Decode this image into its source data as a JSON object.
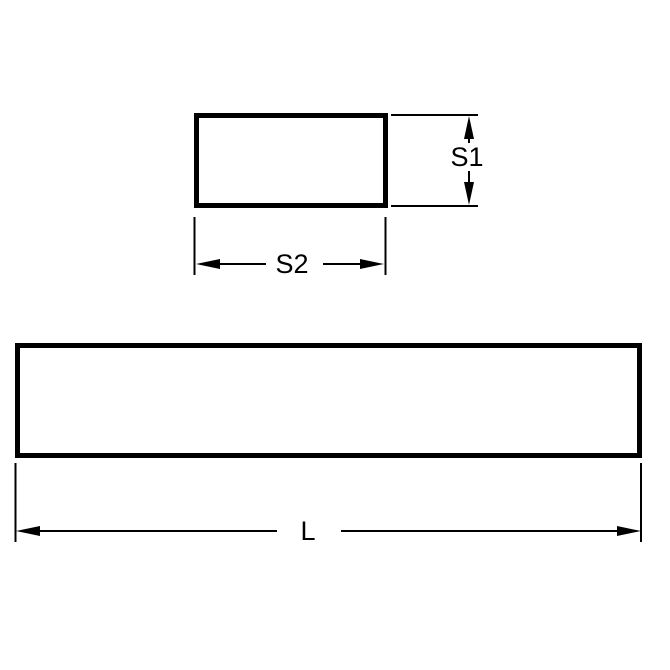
{
  "diagram": {
    "type": "engineering-dimension-drawing",
    "labels": {
      "section_height": "S1",
      "section_width": "S2",
      "length": "L"
    },
    "colors": {
      "line": "#000000",
      "background": "#ffffff"
    }
  }
}
